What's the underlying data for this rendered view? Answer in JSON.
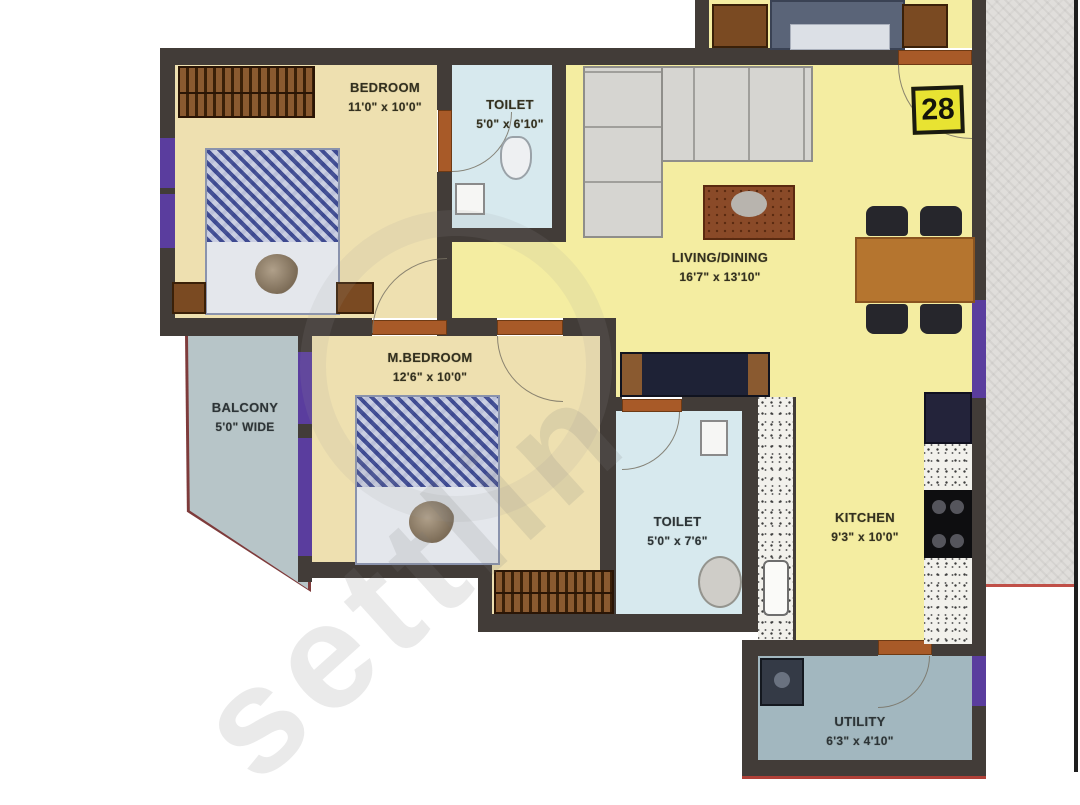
{
  "unit": {
    "number": "28"
  },
  "watermark": {
    "text": "settlin"
  },
  "rooms": {
    "bedroom": {
      "name": "BEDROOM",
      "dims": "11'0\" x 10'0\""
    },
    "toilet1": {
      "name": "TOILET",
      "dims": "5'0\" x 6'10\""
    },
    "living": {
      "name": "LIVING/DINING",
      "dims": "16'7\" x 13'10\""
    },
    "mbedroom": {
      "name": "M.BEDROOM",
      "dims": "12'6\" x 10'0\""
    },
    "balcony": {
      "name": "BALCONY",
      "dims": "5'0\" WIDE"
    },
    "toilet2": {
      "name": "TOILET",
      "dims": "5'0\" x 7'6\""
    },
    "kitchen": {
      "name": "KITCHEN",
      "dims": "9'3\" x 10'0\""
    },
    "utility": {
      "name": "UTILITY",
      "dims": "6'3\" x 4'10\""
    }
  },
  "colors": {
    "wall": "#423c38",
    "window": "#5a3d9e",
    "door": "#a85a28",
    "room_yellow": "#f4eda1",
    "room_tan": "#eee0b0",
    "toilet_blue": "#d7e9ee",
    "balcony_gray": "#b7c5c8",
    "utility_gray": "#a2b7bf",
    "badge_yellow": "#e8e332",
    "outer_red": "#b04038"
  }
}
